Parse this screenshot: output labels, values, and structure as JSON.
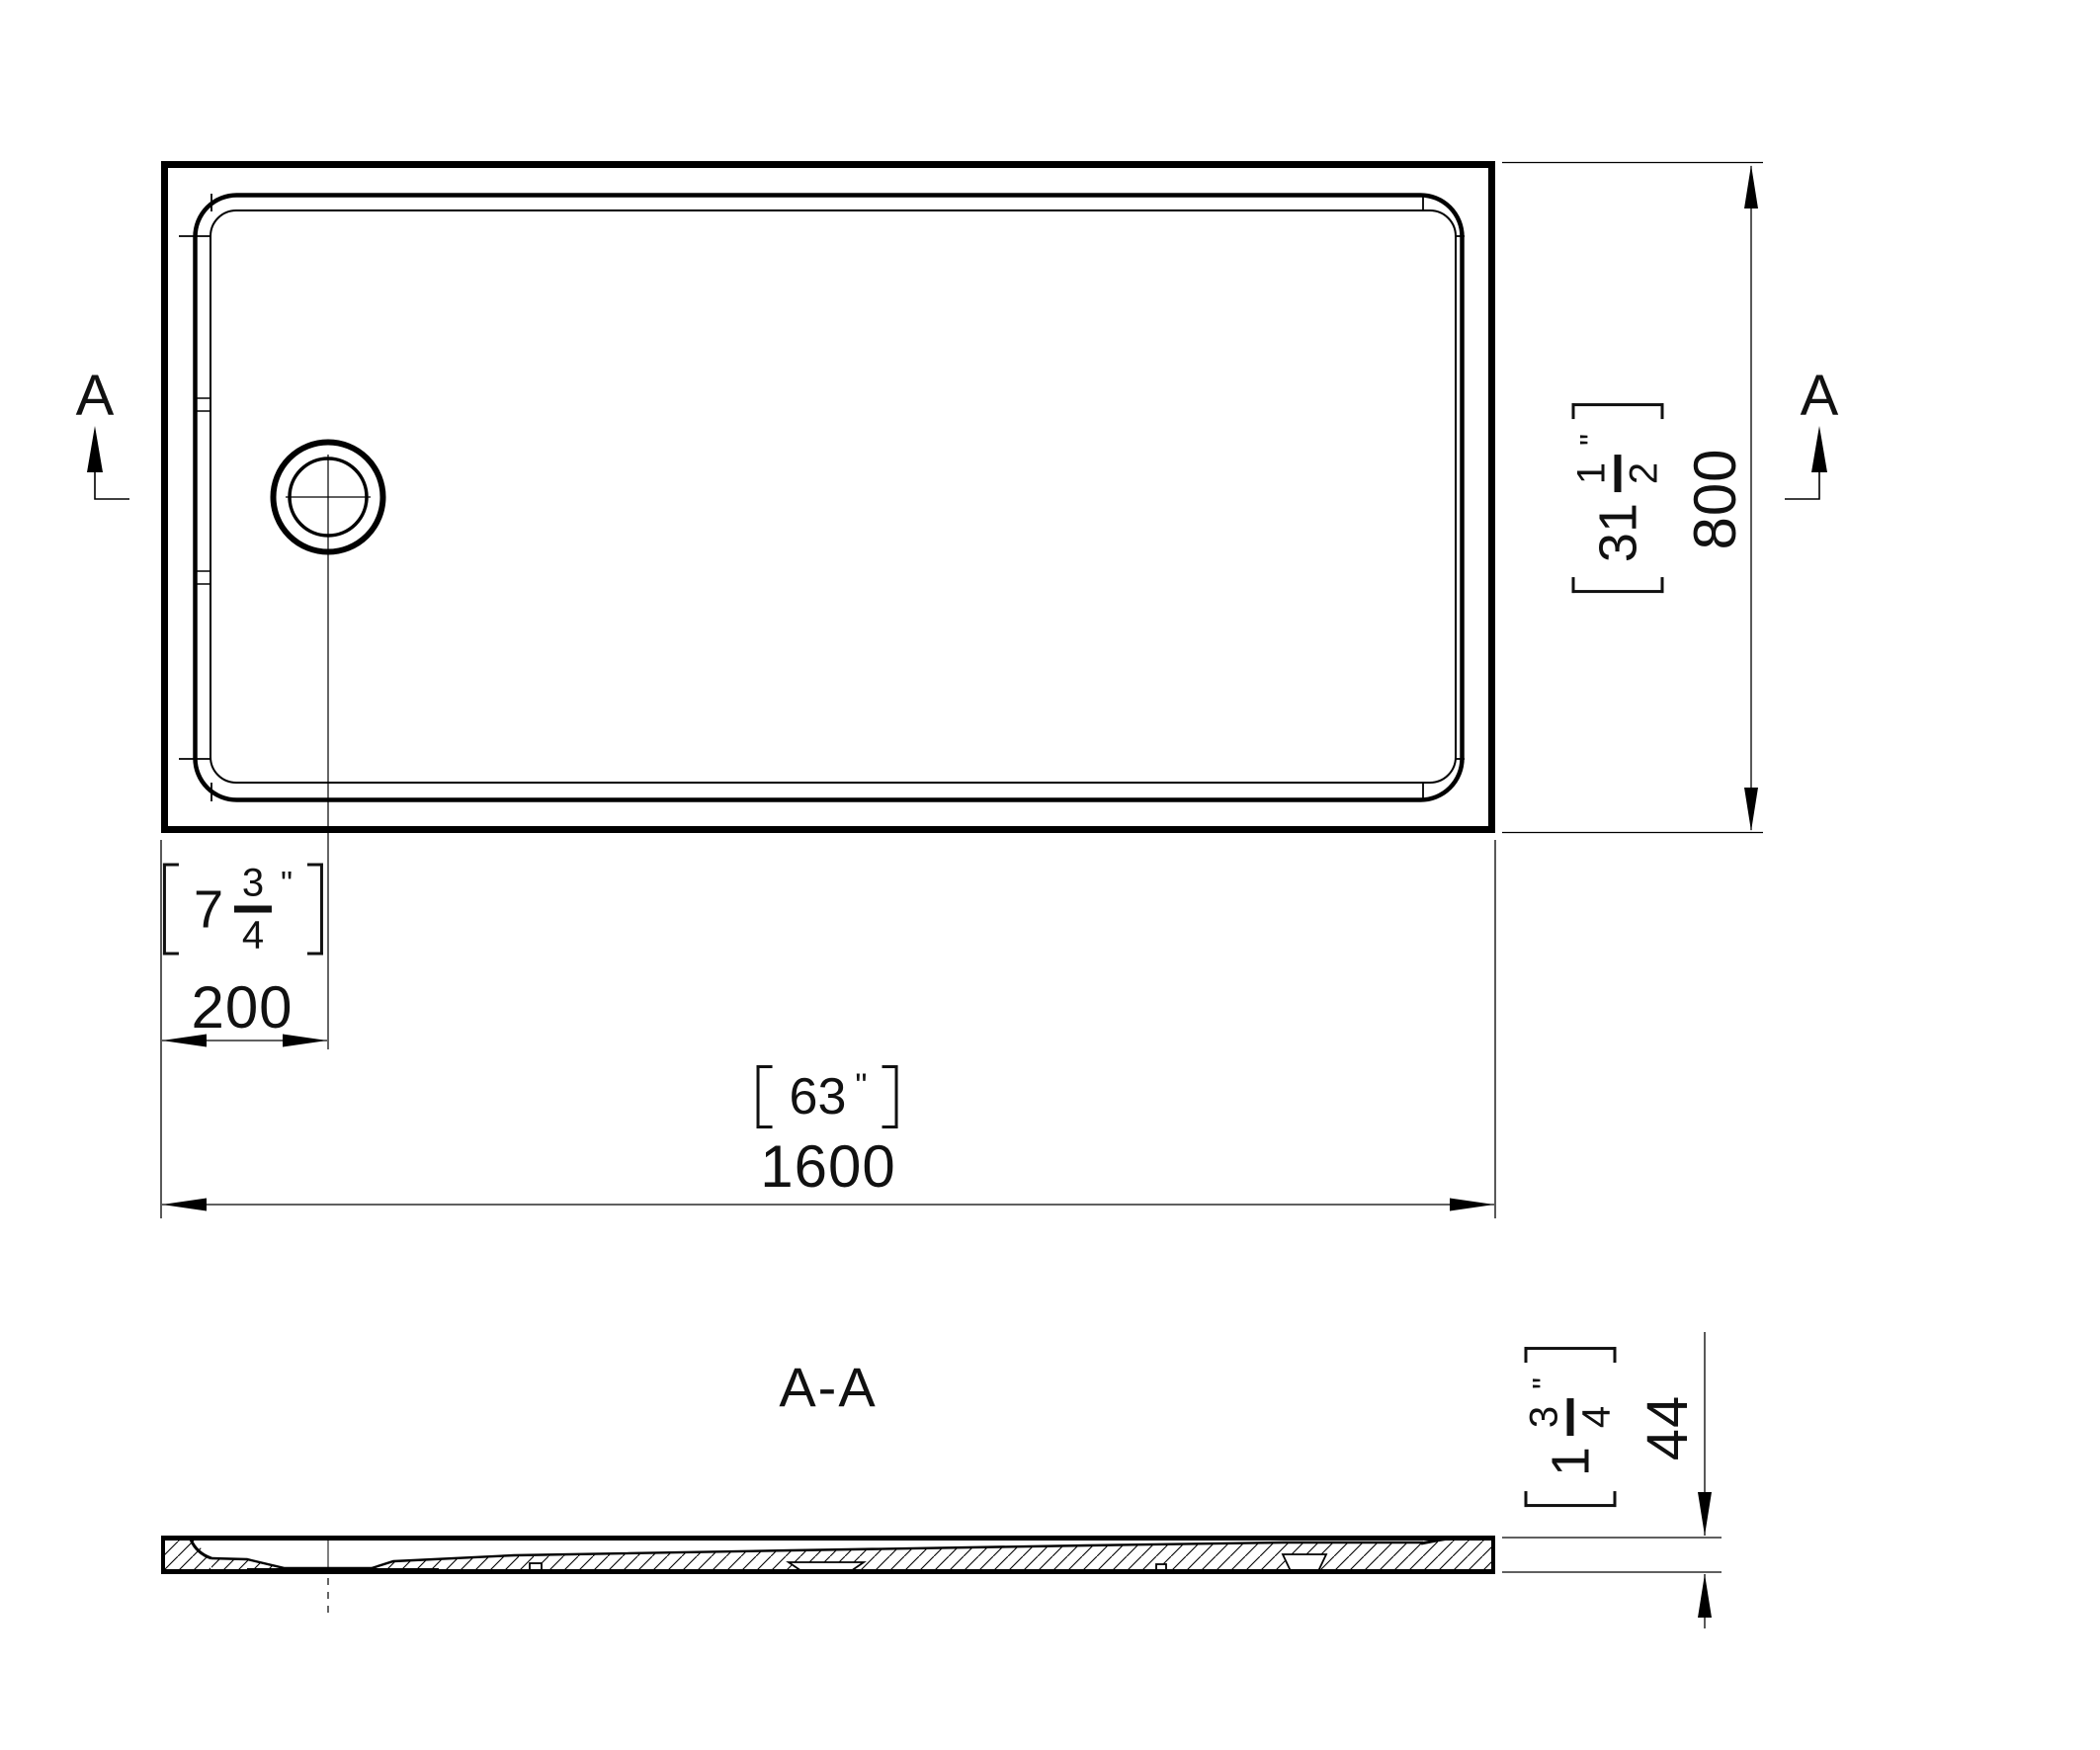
{
  "colors": {
    "ink": "#000000",
    "background": "#ffffff"
  },
  "section_markers": {
    "left": "A",
    "right": "A"
  },
  "section_view": {
    "label": "A-A"
  },
  "dim_width": {
    "mm": "800",
    "in_whole": "31",
    "in_num": "1",
    "in_den": "2",
    "unit": "\""
  },
  "dim_length": {
    "mm": "1600",
    "in": "63",
    "unit": "\""
  },
  "dim_offset": {
    "mm": "200",
    "in_whole": "7",
    "in_num": "3",
    "in_den": "4",
    "unit": "\""
  },
  "dim_thickness": {
    "mm": "44",
    "in_whole": "1",
    "in_num": "3",
    "in_den": "4",
    "unit": "\""
  }
}
